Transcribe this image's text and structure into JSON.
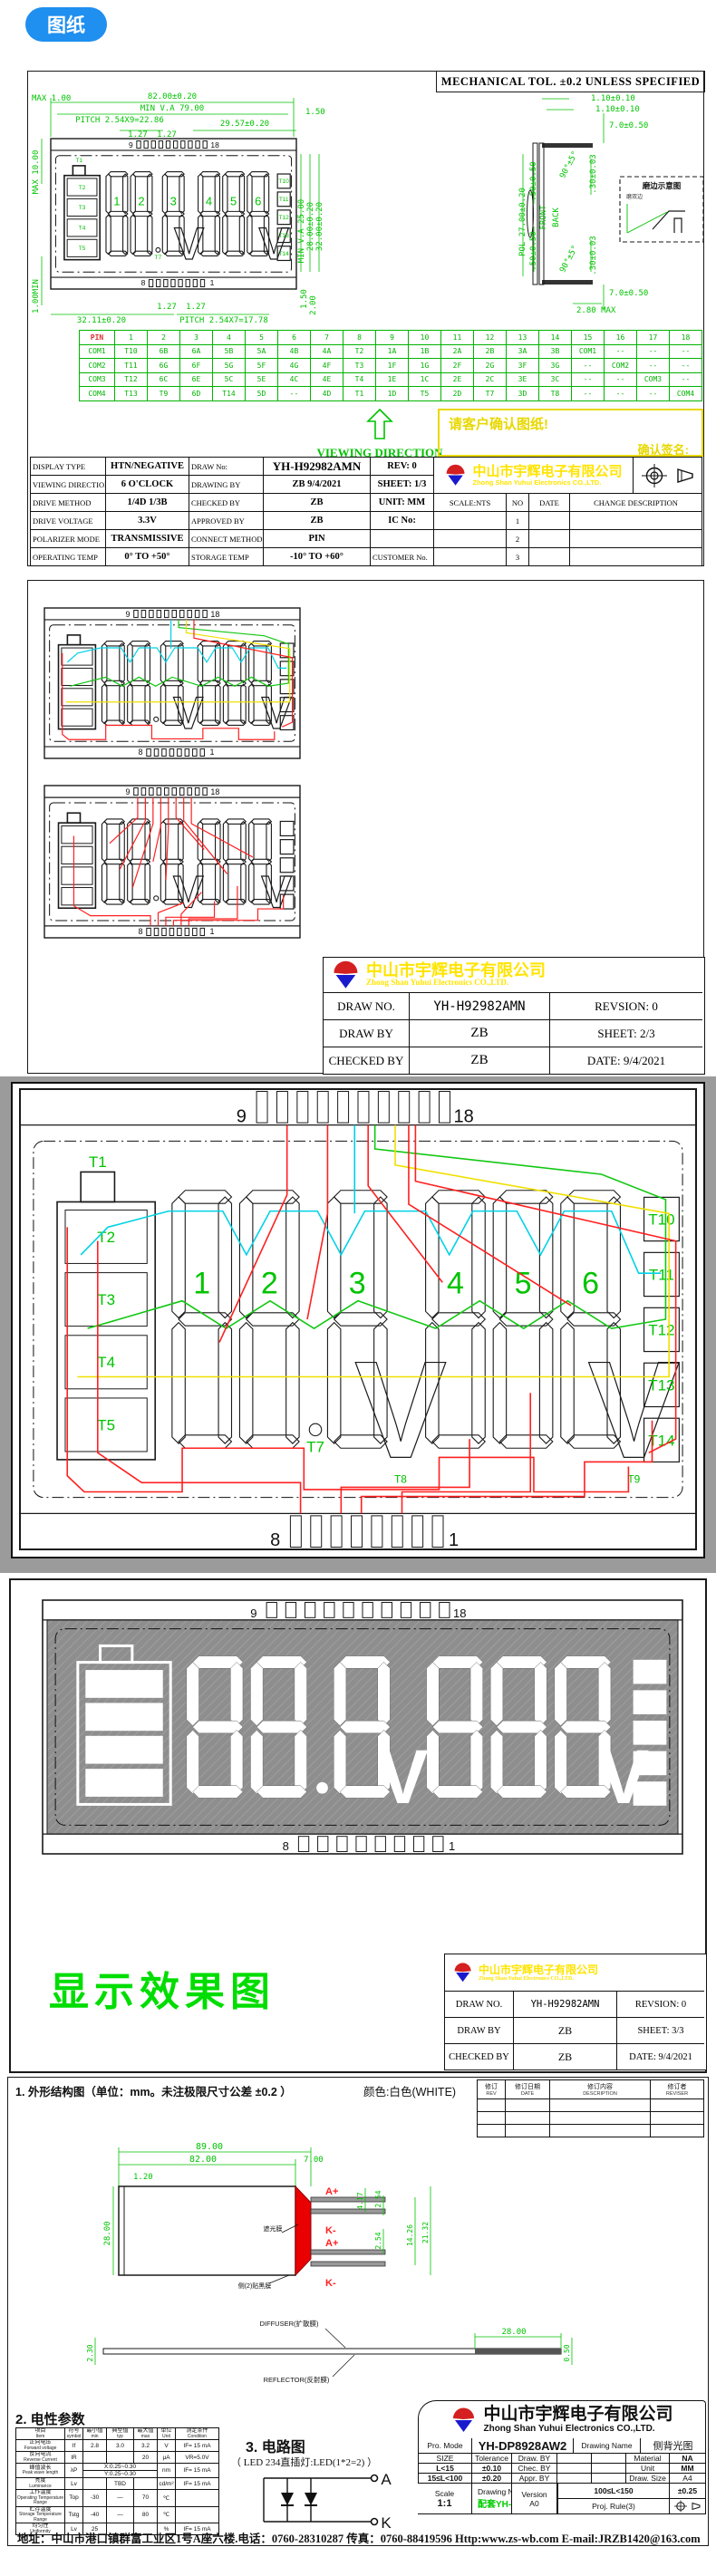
{
  "header_chip": "图纸",
  "company": {
    "cn": "中山市宇辉电子有限公司",
    "en": "Zhong Shan Yuhui Electronics CO.,LTD."
  },
  "colors": {
    "cad_green": "#00c300",
    "cad_red": "#ff2020",
    "cad_yellow": "#f0e000",
    "cad_cyan": "#00d2e6",
    "accent_blue": "#1f8ff0",
    "logo_red": "#d42020",
    "logo_blue": "#1a1acd",
    "model_green": "#00cc00"
  },
  "lcd": {
    "pins": {
      "tl": "9",
      "tr": "18",
      "bl": "8",
      "br": "1"
    },
    "digits": [
      "1",
      "2",
      "3",
      "4",
      "5",
      "6"
    ],
    "battery": [
      "T2",
      "T3",
      "T4",
      "T5"
    ],
    "t1": "T1",
    "t7": "T7",
    "t8": "T8",
    "t9": "T9",
    "right": [
      "T10",
      "T11",
      "T12",
      "T13",
      "T14"
    ],
    "v": "V"
  },
  "sheet1": {
    "tol_note": "MECHANICAL TOL. ±0.2 UNLESS SPECIFIED",
    "viewing_label": "VIEWING DIRECTION",
    "confirm": {
      "line1": "请客户确认图纸!",
      "line2": "确认签名:"
    },
    "front_dims": {
      "max1": "MAX 1.00",
      "w82": "82.00±0.20",
      "minva79": "MIN V.A 79.00",
      "pitch_top": "PITCH 2.54X9=22.86",
      "p127a": "1.27",
      "p127b": "1.27",
      "w2957": "29.57±0.20",
      "r150": "1.50",
      "max10": "MAX 10.00",
      "min100": "1.00MIN",
      "b127a": "1.27",
      "b127b": "1.27",
      "w3211": "32.11±0.20",
      "pitch_bot": "PITCH 2.54X7=17.78",
      "minva25": "MIN V.A 25.00",
      "h2800": "28.00±0.20",
      "h3200": "32.00±0.20",
      "r150b": "1.50",
      "r200": "2.00"
    },
    "side_dims": {
      "t110a": "1.10±0.10",
      "t110b": "1.10±0.10",
      "s70t": "7.0±0.50",
      "s70b": "7.0±0.50",
      "angt": "90°±5°",
      "angb": "90°±5°",
      "d030t": ".30±0.03",
      "d030b": ".30±0.03",
      "pol": "POL 27.00±0.20",
      "d50a": ".50±0.50",
      "d50b": ".50±0.50",
      "front": "FRONT",
      "back": "BACK",
      "max280": "2.80 MAX"
    },
    "detail": {
      "title": "磨边示意图",
      "note": "磨双边"
    },
    "pin_table": {
      "header": [
        "PIN",
        "1",
        "2",
        "3",
        "4",
        "5",
        "6",
        "7",
        "8",
        "9",
        "10",
        "11",
        "12",
        "13",
        "14",
        "15",
        "16",
        "17",
        "18"
      ],
      "rows": [
        [
          "COM1",
          "T10",
          "6B",
          "6A",
          "5B",
          "5A",
          "4B",
          "4A",
          "T2",
          "1A",
          "1B",
          "2A",
          "2B",
          "3A",
          "3B",
          "COM1",
          "--",
          "--",
          "--"
        ],
        [
          "COM2",
          "T11",
          "6G",
          "6F",
          "5G",
          "5F",
          "4G",
          "4F",
          "T3",
          "1F",
          "1G",
          "2F",
          "2G",
          "3F",
          "3G",
          "--",
          "COM2",
          "--",
          "--"
        ],
        [
          "COM3",
          "T12",
          "6C",
          "6E",
          "5C",
          "5E",
          "4C",
          "4E",
          "T4",
          "1E",
          "1C",
          "2E",
          "2C",
          "3E",
          "3C",
          "--",
          "--",
          "COM3",
          "--"
        ],
        [
          "COM4",
          "T13",
          "T9",
          "6D",
          "T14",
          "5D",
          "--",
          "4D",
          "T1",
          "1D",
          "T5",
          "2D",
          "T7",
          "3D",
          "T8",
          "--",
          "--",
          "--",
          "COM4"
        ]
      ]
    },
    "spec": {
      "r1": {
        "l1": "DISPLAY TYPE",
        "v1": "HTN/NEGATIVE",
        "l2": "DRAW No:",
        "v2": "YH-H92982AMN",
        "f": "REV:   0"
      },
      "r2": {
        "l1": "VIEWING DIRECTION",
        "v1": "6 O'CLOCK",
        "l2": "DRAWING BY",
        "v2": "ZB   9/4/2021",
        "f": "SHEET: 1/3"
      },
      "r3": {
        "l1": "DRIVE METHOD",
        "v1": "1/4D  1/3B",
        "l2": "CHECKED BY",
        "v2": "ZB",
        "f": "UNIT: MM",
        "g1": "SCALE:NTS",
        "g2": "NO",
        "g3": "DATE",
        "g4": "CHANGE DESCRIPTION"
      },
      "r4": {
        "l1": "DRIVE VOLTAGE",
        "v1": "3.3V",
        "l2": "APPROVED BY",
        "v2": "ZB",
        "f": "IC No:",
        "no": "1"
      },
      "r5": {
        "l1": "POLARIZER MODE",
        "v1": "TRANSMISSIVE",
        "l2": "CONNECT METHOD",
        "v2": "PIN",
        "f": "",
        "no": "2"
      },
      "r6": {
        "l1": "OPERATING TEMP",
        "v1": "0° TO +50°",
        "l2": "STORAGE TEMP",
        "v2": "-10° TO +60°",
        "f": "CUSTOMER No.",
        "no": "3"
      }
    }
  },
  "sheet2": {
    "block": {
      "r1": [
        "DRAW NO.",
        "YH-H92982AMN",
        "REVSION:  0"
      ],
      "r2": [
        "DRAW BY",
        "ZB",
        "SHEET: 2/3"
      ],
      "r3": [
        "CHECKED BY",
        "ZB",
        "DATE: 9/4/2021"
      ]
    }
  },
  "sheet3": {
    "effect_title": "显示效果图",
    "block": {
      "r1": [
        "DRAW NO.",
        "YH-H92982AMN",
        "REVSION:  0"
      ],
      "r2": [
        "DRAW BY",
        "ZB",
        "SHEET: 3/3"
      ],
      "r3": [
        "CHECKED BY",
        "ZB",
        "DATE: 9/4/2021"
      ]
    }
  },
  "backlight": {
    "section1_title": "1. 外形结构图（单位：mm。未注极限尺寸公差 ±0.2 ）",
    "color_note": "颜色:白色(WHITE)",
    "rev_table": {
      "headers": [
        [
          "修订",
          "REV"
        ],
        [
          "修订日期",
          "DATE"
        ],
        [
          "修订内容",
          "DESCRIPTION"
        ],
        [
          "修订者",
          "REVISER"
        ]
      ]
    },
    "outline_dims": {
      "d89": "89.00",
      "d82": "82.00",
      "d120": "1.20",
      "d700": "7.00",
      "d2800": "28.00",
      "d417": "4.17",
      "d254a": "2.54",
      "d254b": "2.54",
      "d1426": "14.26",
      "d2132": "21.32",
      "a1": "A+",
      "k1": "K-",
      "a2": "A+",
      "k2": "K-",
      "shade": "遮光膜",
      "black_film": "侧(2)贴黑膜"
    },
    "film_dims": {
      "d230": "2.30",
      "d050": "0.50",
      "d2800": "28.00",
      "diffuser": "DIFFUSER(扩散膜)",
      "reflector": "REFLECTOR(反射膜)"
    },
    "section2_title": "2. 电性参数",
    "elec": {
      "headers": [
        [
          "项目",
          "Item"
        ],
        [
          "符号",
          "symbol"
        ],
        [
          "最小值",
          "min"
        ],
        [
          "典型值",
          "typ"
        ],
        [
          "最大值",
          "max"
        ],
        [
          "单位",
          "Unit"
        ],
        [
          "测定条件",
          "Condition"
        ]
      ],
      "rows": [
        {
          "cn": "正向电压",
          "en": "Forward voltage",
          "sym": "If",
          "min": "2.8",
          "typ": "3.0",
          "max": "3.2",
          "unit": "V",
          "cond": "IF= 15 mA"
        },
        {
          "cn": "反向电流",
          "en": "Reverse Current",
          "sym": "IR",
          "min": "",
          "typ": "",
          "max": "20",
          "unit": "μA",
          "cond": "VR=5.0V"
        },
        {
          "cn": "峰值波长",
          "en": "Peak wave length",
          "sym": "λP",
          "span_top": "X:0.25~0.30",
          "span_bot": "Y:0.25~0.30",
          "unit": "nm",
          "cond": "IF= 15 mA"
        },
        {
          "cn": "亮度",
          "en": "Luminance",
          "sym": "Lv",
          "min": "",
          "typ": "TBD",
          "max": "",
          "unit": "cd/m²",
          "cond": "IF= 15 mA"
        },
        {
          "cn": "工作温度",
          "en": "Operating Temperature Range",
          "sym": "Top",
          "min": "-30",
          "typ": "—",
          "max": "70",
          "unit": "℃",
          "cond": ""
        },
        {
          "cn": "贮存温度",
          "en": "Storage Temperature Range",
          "sym": "Tstg",
          "min": "-40",
          "typ": "—",
          "max": "80",
          "unit": "℃",
          "cond": ""
        },
        {
          "cn": "均匀性",
          "en": "Uniformity",
          "sym": "Lv",
          "min": "25",
          "typ": "",
          "max": "",
          "unit": "%",
          "cond": "IF= 15 mA"
        }
      ]
    },
    "section3_title": "3. 电路图",
    "circuit_sub": "（ LED 234直插灯:LED(1*2=2) ）",
    "circuit": {
      "a": "A",
      "k": "K"
    },
    "tb": {
      "pro_mode_label": "Pro. Mode",
      "pro_mode": "YH-DP8928AW2",
      "drawing_name_label": "Drawing Name",
      "drawing_name": "侧背光图",
      "size_label": "SIZE",
      "tol_label": "Tolerance",
      "row_labels": [
        "Draw. BY",
        "Chec. BY",
        "Appr. BY"
      ],
      "size_rows": [
        [
          "L<15",
          "±0.10"
        ],
        [
          "15≤L<100",
          "±0.20"
        ],
        [
          "100≤L<150",
          "±0.25"
        ]
      ],
      "material_label": "Material",
      "material": "NA",
      "unit_label": "Unit",
      "unit": "MM",
      "drawsize_label": "Draw. Size",
      "drawsize": "A4",
      "scale_label": "Scale",
      "scale": "1:1",
      "drawing_no_label": "Drawing NO.",
      "drawing_no": "配套YH-H92982AMN",
      "version_label": "Version",
      "version": "A0",
      "proj_label": "Proj. Rule(3)"
    },
    "address": "地址：中山市港口镇群富工业区1号A座六楼.电话：0760-28310287 传真：0760-88419596 Http:www.zs-wb.com E-mail:JRZB1420@163.com"
  }
}
